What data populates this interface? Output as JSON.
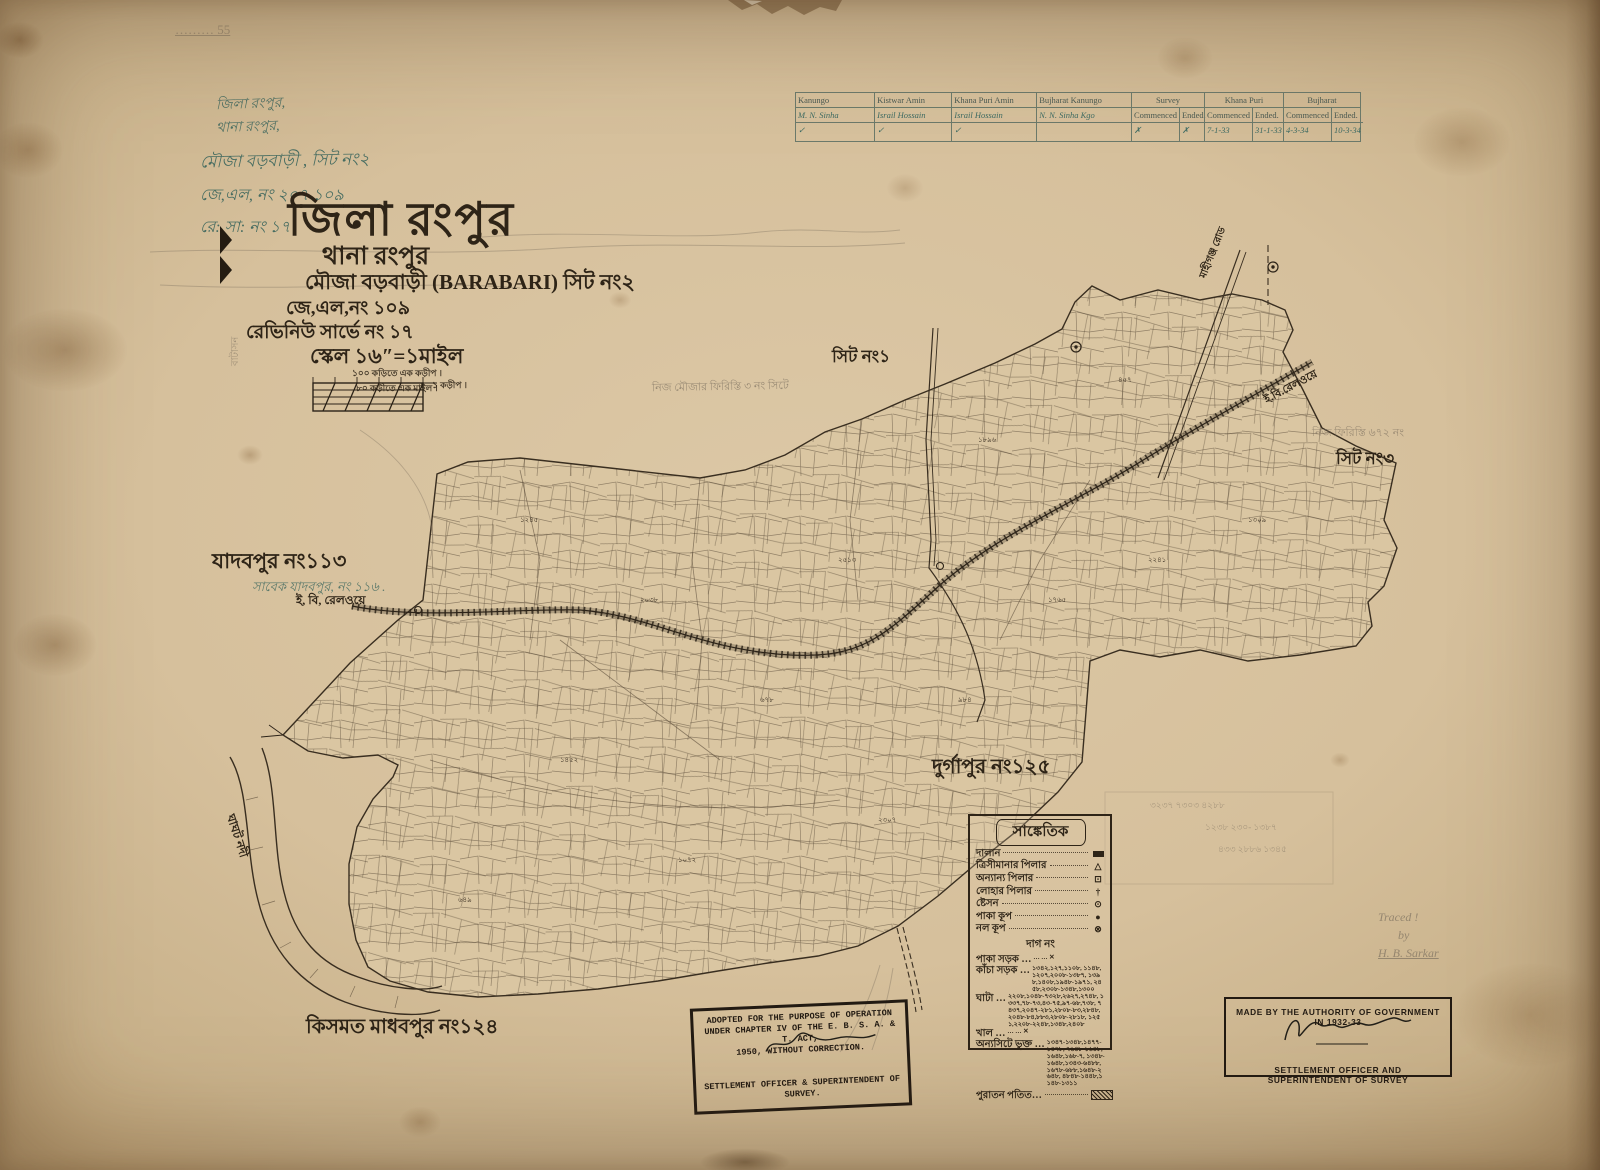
{
  "corner_note": "……… 55",
  "handwritten_header": {
    "line1": "জিলা রংপুর,",
    "line2": "থানা রংপুর,",
    "line3": "মৌজা বড়বাড়ী , সিট নং২",
    "line4": "জে,এল, নং ২০৭ ১০৯",
    "line5": "রে: সা: নং ১৭"
  },
  "title_block": {
    "district": "জিলা রংপুর",
    "thana": "থানা রংপুর",
    "mouza": "মৌজা বড়বাড়ী (BARABARI) সিট নং২",
    "jl_no": "জে,এল,নং ১০৯",
    "revenue_survey_no": "রেভিনিউ সার্ভে নং ১৭",
    "scale": "স্কেল ১৬″=১মাইল",
    "scale_note1": "১০০ কড়িতে এক কড়ীপ ।",
    "scale_note2": "৮০ কড়ীতে এক মাইল ।",
    "scale_bar_label": "১ কড়ীপ ।"
  },
  "survey_table": {
    "sub_commenced": "Commenced",
    "sub_ended": "Ended.",
    "columns": [
      {
        "title": "Kanungo",
        "name": "M. N. Sinha",
        "mark": "✓"
      },
      {
        "title": "Kistwar Amin",
        "name": "Israil Hossain",
        "mark": "✓"
      },
      {
        "title": "Khana Puri Amin",
        "name": "Israil Hossain",
        "mark": "✓"
      },
      {
        "title": "Bujharat Kanungo",
        "name": "N. N. Sinha Kgo",
        "mark": ""
      }
    ],
    "phases": [
      {
        "title": "Survey",
        "commenced": "✗",
        "ended": "✗"
      },
      {
        "title": "Khana Puri",
        "commenced": "7-1-33",
        "ended": "31-1-33"
      },
      {
        "title": "Bujharat",
        "commenced": "4-3-34",
        "ended": "10-3-34"
      }
    ]
  },
  "map_labels": {
    "sheet1": "সিট নং১",
    "sheet3": "সিট নং৩",
    "jadabpur": "যাদবপুর নং১১৩",
    "jadabpur_pencil": "সাবেক যাদবপুর, নং ১১৬ .",
    "railway_left": "ই, বি, রেলওয়ে",
    "railway_right": "ই.বি.রেলওয়ে",
    "durgapur": "দুর্গাপুর নং১২৫",
    "kismat": "কিসমত মাধবপুর নং১২৪",
    "river": "ঘাঘট নদী",
    "road_mahiganj": "মাহীগঞ্জ রোড",
    "pencil_note_center": "নিজ মৌজার ফিরিস্তি ৩ নং সিটে",
    "pencil_note_right": "নিজ ফিরিস্তি ৬৭২ নং",
    "left_vertical_note": "বাটাসন"
  },
  "map": {
    "plot_numbers": [
      "১২৪৫",
      "২০৩৮",
      "৬৭৮",
      "১৪৫২",
      "২৩০৭",
      "৯৮৪",
      "১৭৬৫",
      "২২৪১",
      "১৩০৯",
      "৪৫৭",
      "১৮৯৬",
      "২৫১৩",
      "১০৭২",
      "৬৪৯"
    ]
  },
  "legend": {
    "title": "সাঙ্কেতিক",
    "items": [
      {
        "label": "দালান",
        "glyph": ""
      },
      {
        "label": "ত্রিসীমানার পিলার",
        "glyph": "△"
      },
      {
        "label": "অন্যান্য পিলার",
        "glyph": "⊡"
      },
      {
        "label": "লোহার পিলার",
        "glyph": "†"
      },
      {
        "label": "ষ্টেসন",
        "glyph": "⊙"
      },
      {
        "label": "পাকা কূপ",
        "glyph": "●"
      },
      {
        "label": "নল কূপ",
        "glyph": "⊗"
      }
    ],
    "dag_no": "দাগ নং",
    "num_rows": [
      {
        "label": "পাকা সড়ক …",
        "numbers": "… … ✕"
      },
      {
        "label": "কাঁচা সড়ক …",
        "numbers": "১৩৪২,১২৭,১১০৮, ১১৪৮,১২০৭,২০০৮-১৩৮৭, ১৩৯৮,১৪০৮,১৯৪৮-১৯৭১, ২৪৫৮,২৩০৮-১৩৪৮,১৩০০"
      },
      {
        "label": "ঘাটা …",
        "numbers": "২২০৮,১০৪৮-৭৩২৮,২৬২৭,২৭৪৮, ১৩৩৭,৭৮-৭৩,৪৩-৭৫,৯৭-৬৮,৭৩৮, ৭৪৩৭,২০৪৭-২৮১,২৮০৮-৮৩,২৮৪৮, ২০৪৮-৮৪,৮৮৩,২৮০৮-২৮১৮, ১২৫১,২২০৮-২২৪৮,১৩৪৮,২৪০৮"
      },
      {
        "label": "খাল …",
        "numbers": "… … ✕"
      },
      {
        "label": "অন্যসিটে ভুক্ত …",
        "numbers": "১৩৪৭-১৩৪৮,১৪৭৭-১৪৭৮, ৭৬৪৮-১৬৪৮,১৬৪৮,১৬৮-৭, ১৩৪৮-১৬৪৮,১৩৪৩-৬৪৮৮, ১৬৭৮-৬৮৮,১৬৪৮-২৬৪৮, ৪৮৪৮-১৪৪৮,১১৪৮-১৩১১"
      }
    ],
    "puraton": "পুরাতন পতিত…"
  },
  "pencil_sums": {
    "a": "৩২৩৭   ৭৩০৩   ৪২৮৮",
    "b": "১২৩৮   ২৩০-   ১৩৮৭",
    "c": "৪৩৩   ২৮৮৬   ১৩৪৫"
  },
  "stamps": {
    "adopted": {
      "line1": "ADOPTED FOR THE PURPOSE OF OPERATION",
      "line2": "UNDER CHAPTER IV OF THE E. B. S. A. & T. ACT,",
      "line3": "1950, WITHOUT CORRECTION.",
      "line4": "SETTLEMENT OFFICER & SUPERINTENDENT OF",
      "line5": "SURVEY."
    },
    "authority": {
      "line1": "MADE BY THE AUTHORITY OF GOVERNMENT IN 1932-33",
      "line2": "SETTLEMENT OFFICER AND SUPERINTENDENT OF SURVEY"
    }
  },
  "traced": {
    "line1": "Traced !",
    "line2": "by",
    "line3": "H. B. Sarkar"
  }
}
